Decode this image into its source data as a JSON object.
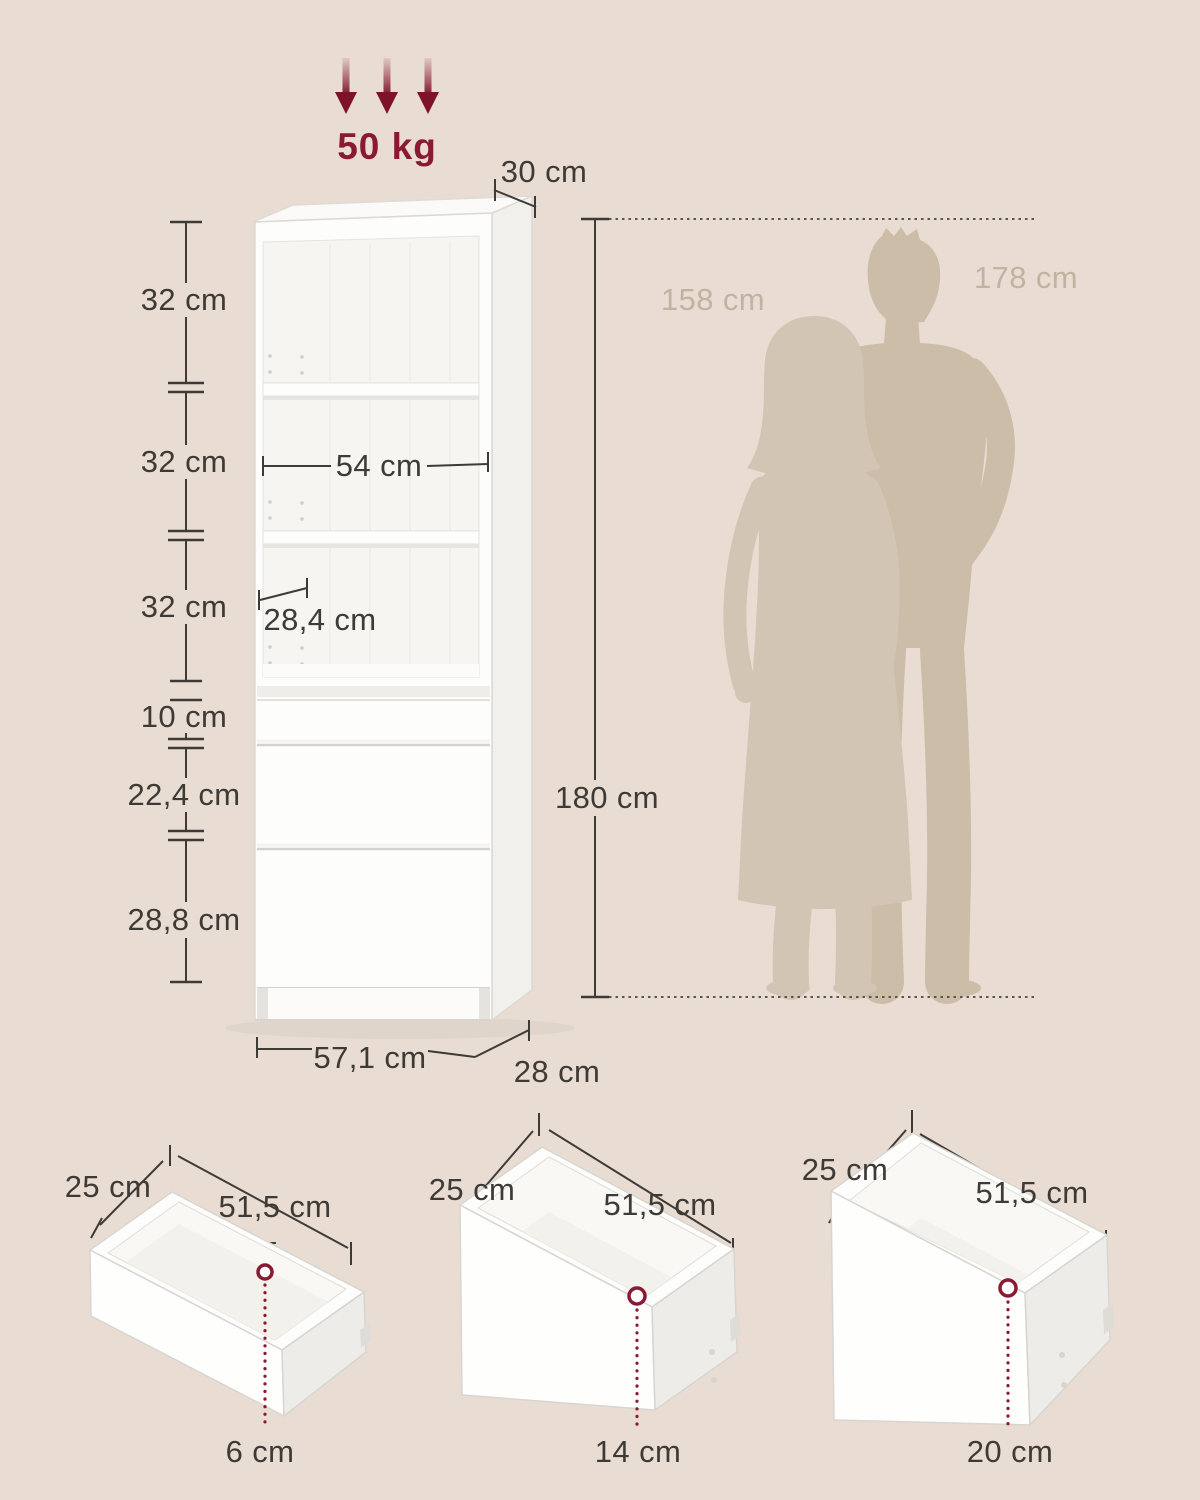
{
  "load_capacity_label": "50 kg",
  "cabinet": {
    "top_depth_label": "30 cm",
    "shelf_height_labels": [
      "32 cm",
      "32 cm",
      "32 cm"
    ],
    "inner_width_label": "54 cm",
    "shelf_depth_label": "28,4 cm",
    "drawer_front_height_labels": [
      "10 cm",
      "22,4 cm",
      "28,8 cm"
    ],
    "total_height_label": "180 cm",
    "width_label": "57,1 cm",
    "bottom_depth_label": "28 cm"
  },
  "size_reference": {
    "woman_height_label": "158 cm",
    "man_height_label": "178 cm"
  },
  "drawer_details": [
    {
      "depth_label": "25 cm",
      "width_label": "51,5 cm",
      "height_label": "6 cm"
    },
    {
      "depth_label": "25 cm",
      "width_label": "51,5 cm",
      "height_label": "14 cm"
    },
    {
      "depth_label": "25 cm",
      "width_label": "51,5 cm",
      "height_label": "20 cm"
    }
  ],
  "colors": {
    "background": "#e9ddd3",
    "accent": "#8a1a32",
    "dimension_line": "#3e3a36",
    "silhouette_man": "#ccbda9",
    "silhouette_woman": "#d3c5b3",
    "height_label": "#c2b2a0",
    "furniture_white": "#fdfdfc"
  }
}
